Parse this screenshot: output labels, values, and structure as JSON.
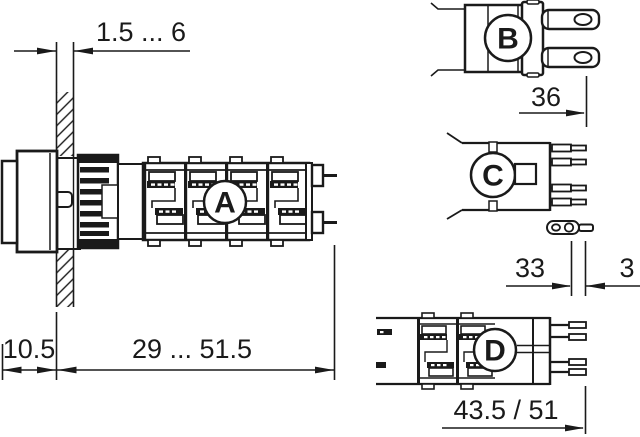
{
  "drawing": {
    "background": "#ffffff",
    "line_color": "#1a1a1a",
    "view_labels": {
      "a": "A",
      "b": "B",
      "c": "C",
      "d": "D"
    },
    "dimensions": {
      "panel_thickness": "1.5 ... 6",
      "front_depth": "10.5",
      "mounting_depth": "29 ... 51.5",
      "connector_width": "36",
      "pin_offset": "33",
      "pin_tip": "3",
      "body_depth": "43.5 / 51"
    }
  }
}
